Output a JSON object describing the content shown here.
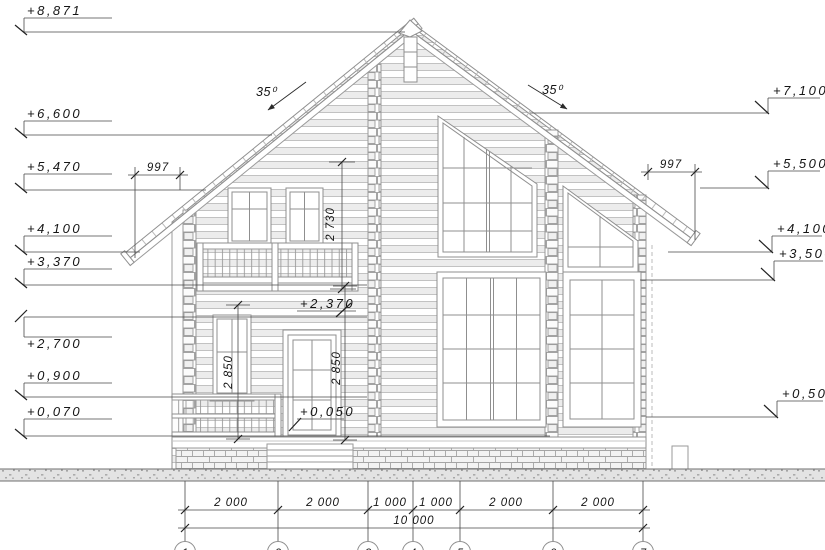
{
  "meta": {
    "type": "architectural-facade-elevation",
    "units": "mm"
  },
  "roof": {
    "angle_left": "35⁰",
    "angle_right": "35⁰"
  },
  "elev_left": [
    "+8,871",
    "+6,600",
    "+5,470",
    "+4,100",
    "+3,370",
    "+2,700",
    "+0,900",
    "+0,070"
  ],
  "elev_right": [
    "+7,100",
    "+5,500",
    "+4,100",
    "+3,500",
    "+0,500"
  ],
  "marks": {
    "door_head": "+2,370",
    "door_sill": "+0,050"
  },
  "vdims": {
    "gable": "2 730",
    "door": "2 850",
    "window": "2 850"
  },
  "hdims": {
    "overhang_left": "997",
    "overhang_right": "997"
  },
  "bottom": {
    "segments": [
      "2 000",
      "2 000",
      "1 000",
      "1 000",
      "2 000",
      "2 000"
    ],
    "total": "10 000"
  },
  "axes": [
    "1",
    "2",
    "3",
    "4",
    "5",
    "6",
    "7"
  ]
}
